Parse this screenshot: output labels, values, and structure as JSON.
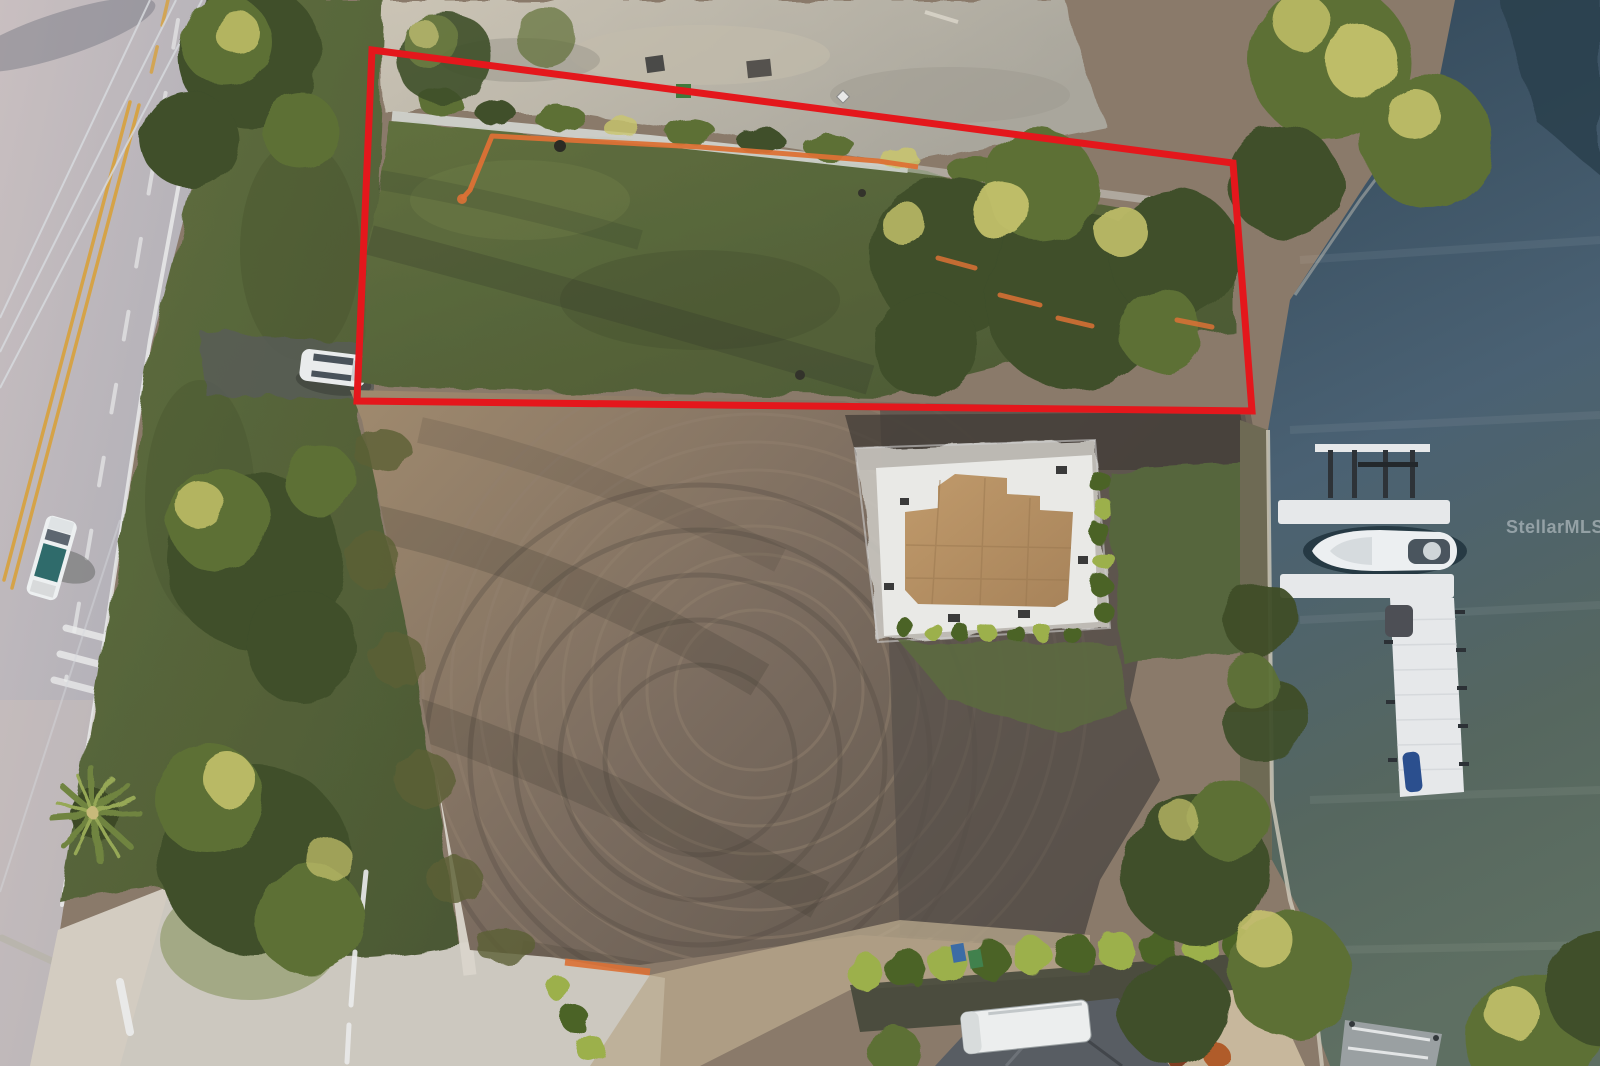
{
  "watermark": {
    "text": "StellarMLS"
  },
  "lot_outline": {
    "points": "372,50 1233,163 1252,411 357,401",
    "stroke_width": 7,
    "color": "#e4171c"
  },
  "silt_fence": {
    "points": "462,199 470,190 492,136 700,147 878,161 918,167",
    "color": "#dc7135"
  },
  "palette": {
    "outline_red": "#e4171c",
    "fence_orange": "#dc7135",
    "watermark": "#ccd3d8",
    "road": "#aeadb6",
    "road_light": "#c9bfc0",
    "lane_yellow": "#d8a13c",
    "lane_white": "#eceded",
    "verge_green": "#6b7a44",
    "tree_dark": "#3f4f2a",
    "tree_mid": "#5d7036",
    "tree_sun": "#c9c56d",
    "lawn": "#57633c",
    "lawn_light": "#72804a",
    "gravel": "#d3d6d2",
    "sand": "#b5afa3",
    "dirt": "#7e6f62",
    "dirt_light": "#a58f74",
    "dirt_dark": "#554d45",
    "slab_white": "#e9e9e6",
    "plywood": "#b58f63",
    "water_dark": "#32485a",
    "water": "#4a6173",
    "water_green": "#5c6e62",
    "dock": "#e6e8ea",
    "hedge": "#4c6428",
    "hedge_sun": "#9cb04c"
  }
}
